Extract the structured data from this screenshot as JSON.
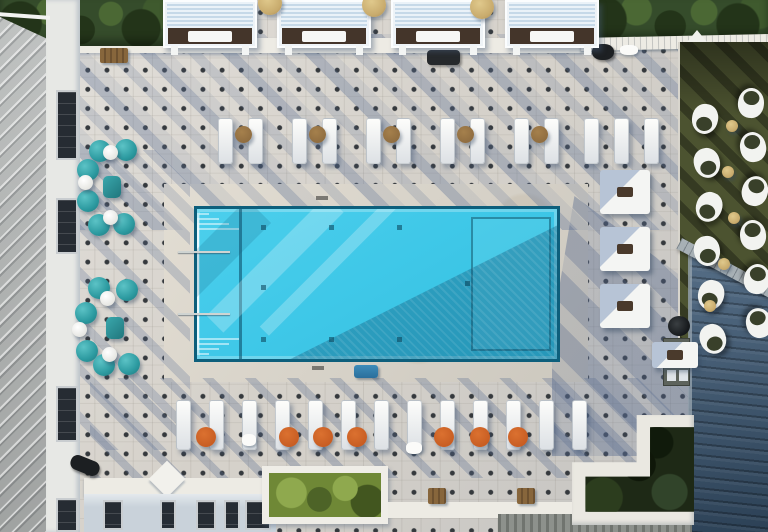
{
  "scene": {
    "description": "Aerial drone view of a rooftop pool deck: turquoise rectangular pool with entry steps and tanning ledge, dotted paver deck, white cabanas with lounge chairs, teal bistro chairs, white daybeds, sculptural lawn chairs on green turf, planters with trees, and surrounding metal roofs casting long diagonal shadows",
    "setting": "outdoor-rooftop-pool",
    "time_of_day": "late-afternoon-long-shadows"
  },
  "colors": {
    "deck": "#d5d1ca",
    "dot": "#35393d",
    "coping": "#d9d2c4",
    "pool_water": "#3fc8e8",
    "pool_rim": "#0d5f7c",
    "teal": "#2c9aa0",
    "teal_dark": "#20767c",
    "orange": "#c0551d",
    "tan": "#c8ab6d",
    "brown": "#87663c",
    "turf": "#4c5330",
    "turf_dark": "#39402a",
    "roof_left": "#b6b9b8",
    "roof_blue": "#3d5a77",
    "ridge_gray": "#a7b0b5",
    "tree": "#354c2b",
    "tree_dark": "#233419",
    "planter_green": "#6f8836",
    "planter_dark": "#1e2916",
    "wall_white": "#edebe4",
    "window_dark": "#262c33",
    "facade": "#c9d2da"
  },
  "furniture": {
    "cabanas": {
      "y": 0,
      "w": 94,
      "h": 48,
      "xs": [
        163,
        277,
        391,
        505
      ]
    },
    "tan_umbrellas": {
      "d": 24,
      "items": [
        [
          258,
          -9
        ],
        [
          362,
          -7
        ],
        [
          470,
          -5
        ]
      ]
    },
    "top_chaises": {
      "y": 118,
      "w": 15,
      "h": 46,
      "xs": [
        218,
        248,
        292,
        322,
        366,
        396,
        440,
        470,
        514,
        544,
        584,
        614,
        644
      ]
    },
    "brown_tables": {
      "y": 126,
      "d": 17,
      "xs": [
        235,
        309,
        383,
        457,
        531
      ]
    },
    "bottom_chaises": {
      "y": 400,
      "w": 15,
      "h": 50,
      "xs": [
        176,
        209,
        242,
        275,
        308,
        341,
        374,
        407,
        440,
        473,
        506,
        539,
        572
      ]
    },
    "orange_tables": {
      "y": 427,
      "d": 20,
      "xs": [
        196,
        279,
        313,
        347,
        434,
        470,
        508
      ]
    },
    "teal_chairs": {
      "d": 22,
      "items": [
        [
          89,
          140
        ],
        [
          115,
          139
        ],
        [
          77,
          159
        ],
        [
          77,
          190
        ],
        [
          88,
          214
        ],
        [
          113,
          213
        ],
        [
          88,
          277
        ],
        [
          116,
          279
        ],
        [
          75,
          302
        ],
        [
          76,
          340
        ],
        [
          93,
          354
        ],
        [
          118,
          353
        ]
      ]
    },
    "white_tables": {
      "d": 15,
      "items": [
        [
          103,
          145
        ],
        [
          78,
          175
        ],
        [
          103,
          210
        ],
        [
          100,
          291
        ],
        [
          72,
          322
        ],
        [
          102,
          347
        ]
      ]
    },
    "teal_poufs": {
      "w": 18,
      "h": 22,
      "items": [
        [
          103,
          176
        ],
        [
          106,
          317
        ]
      ]
    },
    "daybeds": {
      "items": [
        [
          600,
          170,
          50,
          44
        ],
        [
          600,
          227,
          50,
          44
        ],
        [
          600,
          284,
          50,
          44
        ],
        [
          652,
          342,
          46,
          26
        ]
      ]
    },
    "turf_chairs": {
      "w": 26,
      "h": 30,
      "items": [
        [
          692,
          104,
          10
        ],
        [
          738,
          88,
          185
        ],
        [
          694,
          148,
          -15
        ],
        [
          740,
          132,
          170
        ],
        [
          696,
          192,
          20
        ],
        [
          742,
          176,
          195
        ],
        [
          694,
          236,
          -10
        ],
        [
          740,
          220,
          175
        ],
        [
          698,
          280,
          15
        ],
        [
          744,
          264,
          190
        ],
        [
          700,
          324,
          -20
        ],
        [
          746,
          308,
          165
        ]
      ]
    },
    "turf_tables": {
      "d": 12,
      "items": [
        [
          726,
          120
        ],
        [
          722,
          166
        ],
        [
          728,
          212
        ],
        [
          718,
          258
        ],
        [
          704,
          300
        ]
      ]
    },
    "towels": {
      "items": [
        [
          242,
          434,
          14,
          12
        ],
        [
          406,
          442,
          16,
          12
        ],
        [
          620,
          45,
          18,
          10
        ]
      ]
    },
    "benches": {
      "items": [
        [
          100,
          48,
          28,
          15
        ]
      ]
    },
    "brown_squares": {
      "items": [
        [
          428,
          488,
          18,
          16
        ],
        [
          517,
          488,
          18,
          16
        ]
      ]
    },
    "pool_lights": {
      "s": 5,
      "items": [
        [
          64,
          16
        ],
        [
          64,
          76
        ],
        [
          64,
          128
        ],
        [
          132,
          16
        ],
        [
          132,
          128
        ],
        [
          200,
          16
        ],
        [
          200,
          128
        ],
        [
          268,
          72
        ]
      ]
    },
    "wall_windows": {
      "x": 56,
      "w": 22,
      "items": [
        [
          90,
          70
        ],
        [
          198,
          56
        ],
        [
          386,
          56
        ],
        [
          498,
          34
        ]
      ]
    },
    "bottom_windows": {
      "y": 500,
      "h": 30,
      "items": [
        [
          103,
          20
        ],
        [
          160,
          16
        ],
        [
          196,
          20
        ],
        [
          224,
          16
        ],
        [
          245,
          26
        ]
      ]
    },
    "cabinet_slots": {
      "cols": [
        3,
        15
      ],
      "rows": [
        3,
        17,
        31
      ]
    }
  }
}
